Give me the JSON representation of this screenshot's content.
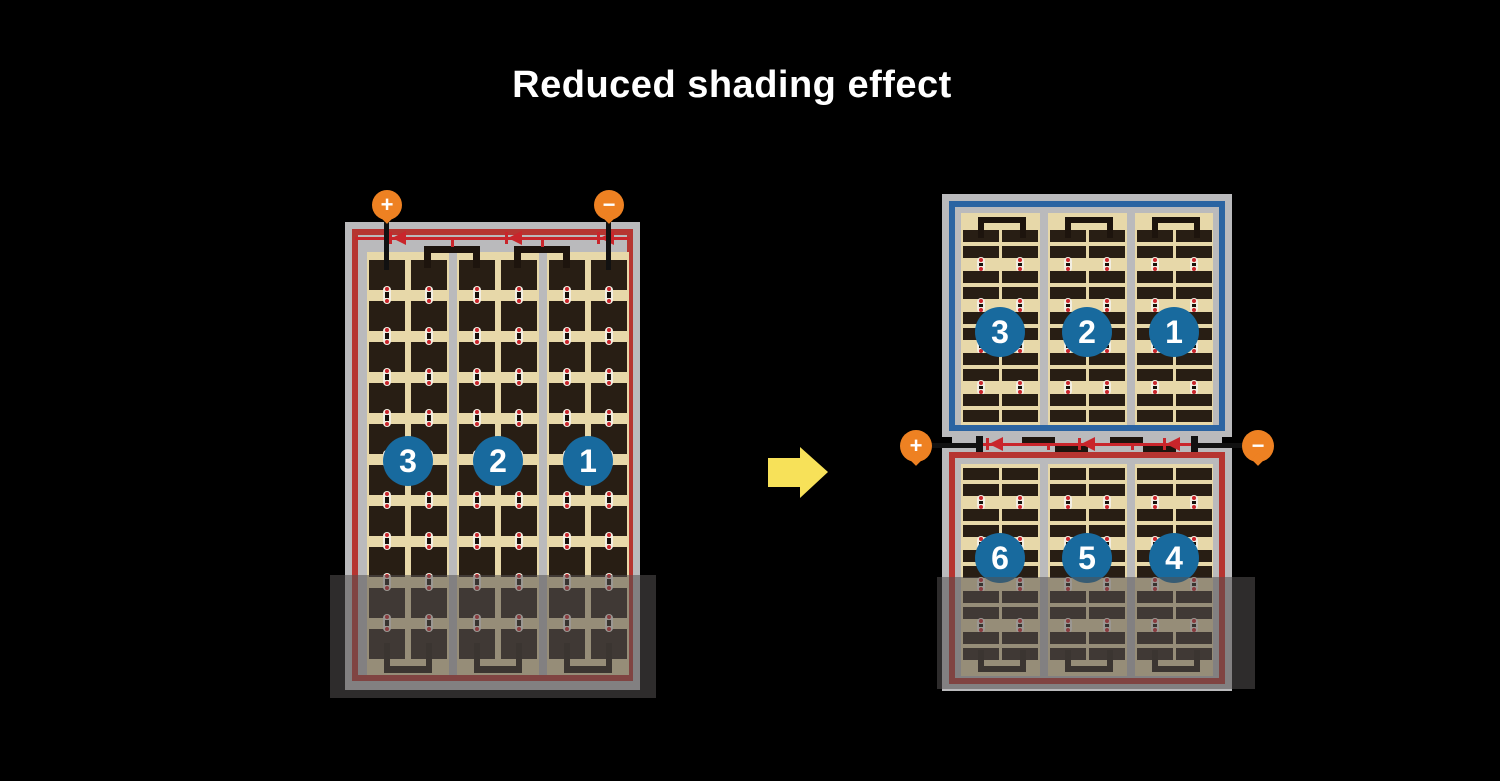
{
  "title": "Reduced shading effect",
  "colors": {
    "background": "#000000",
    "title_text": "#ffffff",
    "panel_frame": "#bababc",
    "cell_area_tan": "#e7d8a9",
    "cell_dark": "#281e14",
    "busbar_black": "#1d140d",
    "string_red": "#b63531",
    "diode_red": "#c9252b",
    "string_blue": "#2b64a2",
    "terminal_orange": "#ee8122",
    "number_circle_blue": "#186a9e",
    "arrow_yellow": "#f7e159",
    "shading_overlay": "rgba(84,81,80,0.55)",
    "dot_white": "#f2eee2"
  },
  "left_panel": {
    "terminals": {
      "positive": "+",
      "negative": "−"
    },
    "string_numbers": [
      "3",
      "2",
      "1"
    ],
    "sections": 3,
    "cell_rows": 10,
    "cell_columns_per_section": 2,
    "bypass_diodes": 3,
    "shaded_bottom": true
  },
  "right_panel": {
    "terminals": {
      "positive": "+",
      "negative": "−"
    },
    "top_string_numbers": [
      "3",
      "2",
      "1"
    ],
    "bottom_string_numbers": [
      "6",
      "5",
      "4"
    ],
    "sections_per_half": 3,
    "strip_row_pairs_per_half": 5,
    "bypass_diodes": 3,
    "shaded_bottom": true
  }
}
